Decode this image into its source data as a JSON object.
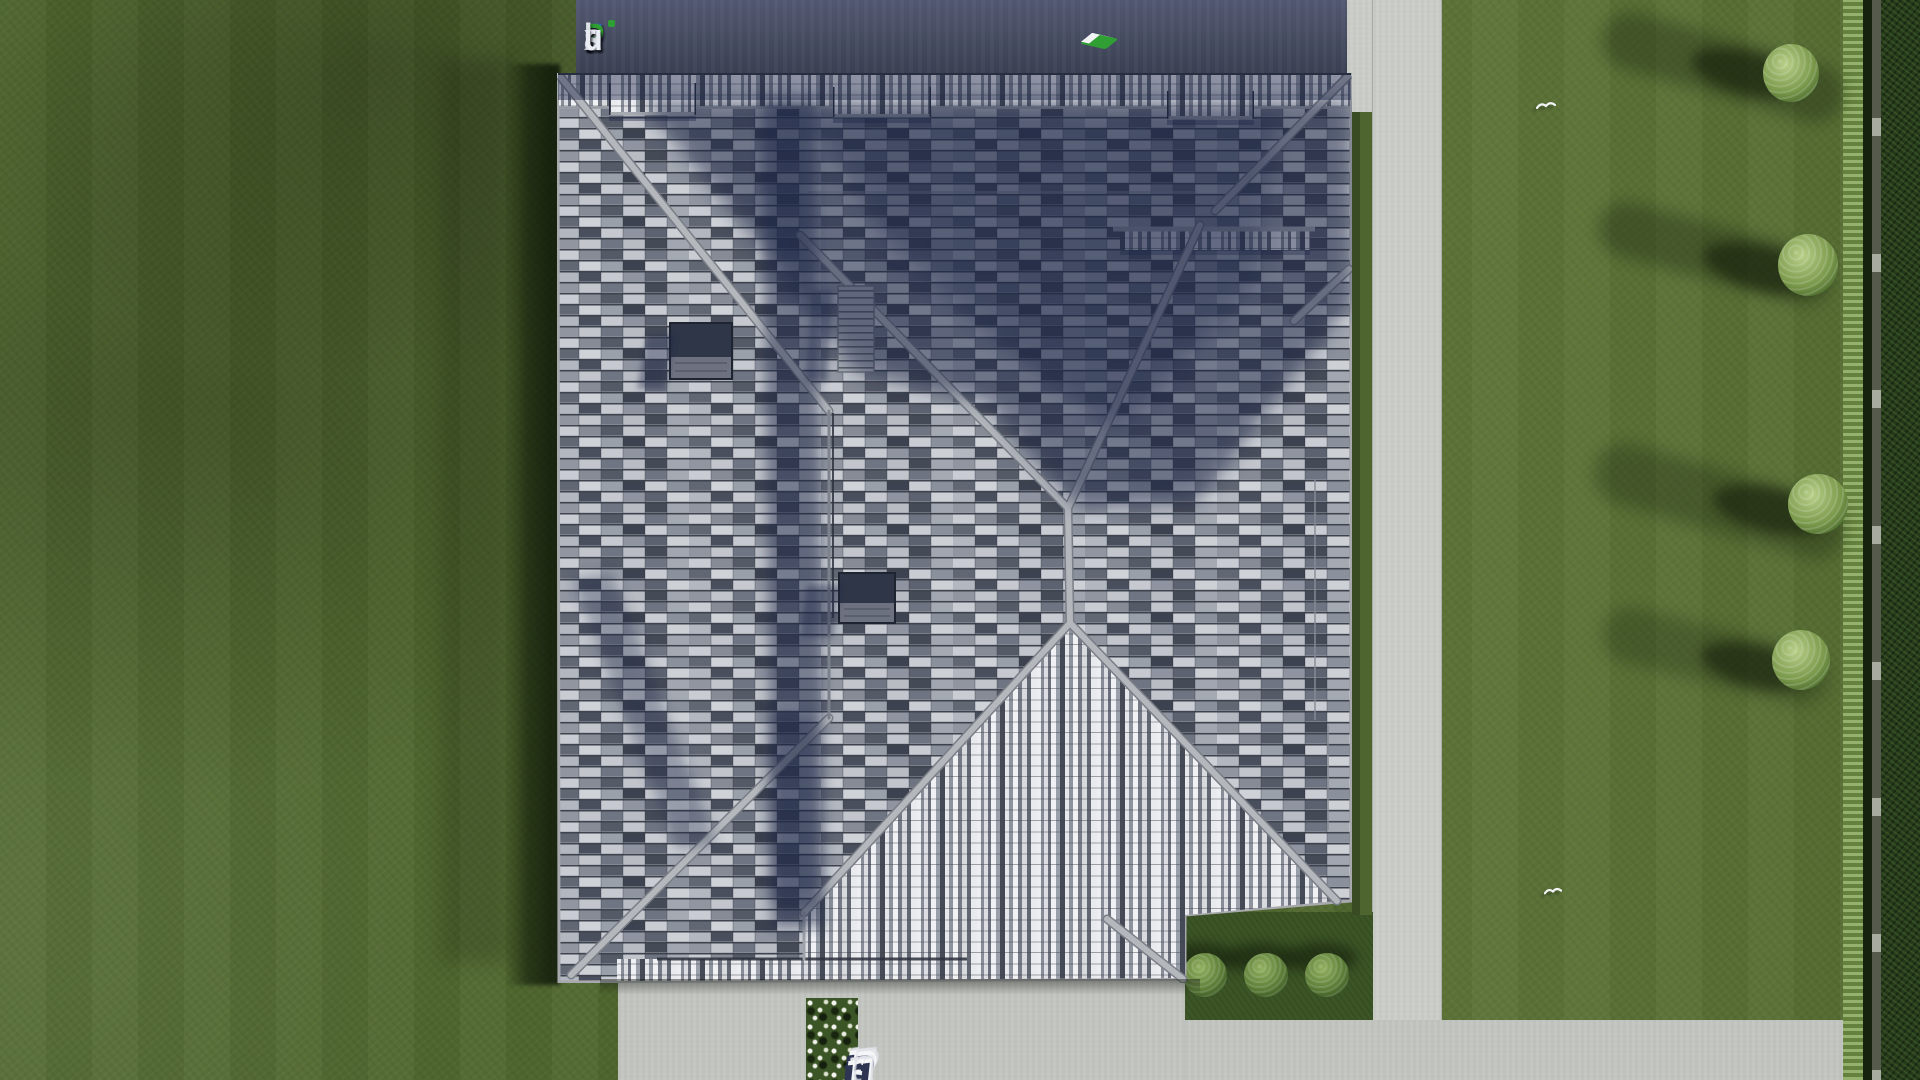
{
  "watermarks": {
    "logo": {
      "text": "FixPlans.ru",
      "letters": [
        {
          "ch": "F",
          "color": "#2a62d8"
        },
        {
          "ch": "i",
          "color": "#e9ecf2"
        },
        {
          "ch": "x",
          "color": "#e9ecf2"
        },
        {
          "ch": "P",
          "color": "#2f9e33"
        },
        {
          "ch": "l",
          "color": "#dde0e7"
        },
        {
          "ch": "a",
          "color": "#dde0e7"
        },
        {
          "ch": "n",
          "color": "#dde0e7"
        },
        {
          "ch": "s",
          "color": "#dde0e7"
        },
        {
          "ch": ".",
          "color": "#2a55c8"
        },
        {
          "ch": "r",
          "color": "#e9ecf2"
        },
        {
          "ch": "u",
          "color": "#e9ecf2"
        }
      ]
    },
    "bottom_3d": {
      "text": "FixPlans.ru",
      "letters": [
        {
          "ch": "F",
          "color": "#2d3552"
        },
        {
          "ch": "i",
          "color": "#2d3552"
        },
        {
          "ch": "x",
          "color": "#2d3552"
        },
        {
          "ch": "P",
          "color": "#2d3552"
        },
        {
          "ch": "l",
          "color": "#2d3552"
        },
        {
          "ch": "a",
          "color": "#2d3552"
        },
        {
          "ch": "n",
          "color": "#2d3552"
        },
        {
          "ch": "s",
          "color": "#2d3552"
        },
        {
          "ch": ".",
          "color": "#23a3e6"
        },
        {
          "ch": "r",
          "color": "#2d3552"
        },
        {
          "ch": "u",
          "color": "#2d3552"
        }
      ]
    },
    "topright_3d": {
      "label": "FixPlans.ru"
    }
  },
  "palette": {
    "grass-base": "#51682f",
    "grass-right": "#5a7238",
    "bed-grass": "#3c5526",
    "hedge-dark": "#243a1b",
    "hedge-light": "#7fa04e",
    "path": "#cbcdc9",
    "concrete": "#c3c5c1",
    "band-top": "#454b5f",
    "roof-light": "#c9ccd2",
    "roof-mid": "#8b909b",
    "roof-dark": "#3d4250",
    "ridge": "#b2b5bb",
    "shadow-navy": "#1d2646",
    "logo-blue": "#2a62d8",
    "logo-green": "#2f9e33",
    "dot-cyan": "#23a3e6",
    "wm-navy": "#2d3552"
  }
}
